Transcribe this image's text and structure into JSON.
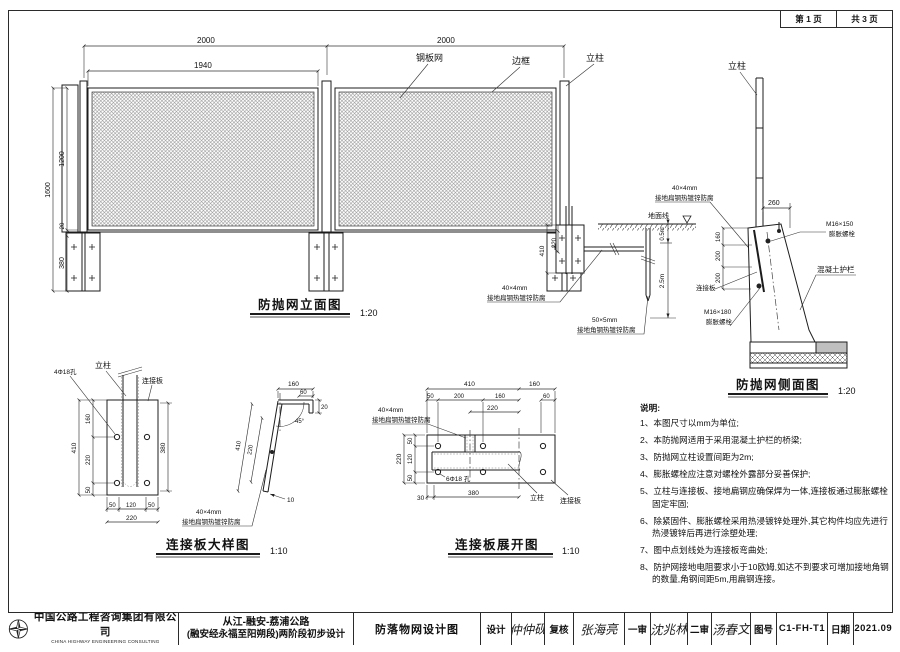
{
  "sheet": {
    "page_label": "第 1 页",
    "pages_label": "共 3 页"
  },
  "elevation": {
    "title": "防抛网立面图",
    "scale": "1:20",
    "dim_span1": "2000",
    "dim_span2": "2000",
    "dim_mesh_w": "1940",
    "dim_total_h": "1600",
    "dim_mesh_h": "1200",
    "dim_gap": "20",
    "dim_plate_h": "380",
    "label_mesh": "钢板网",
    "label_frame": "边框",
    "label_post": "立柱"
  },
  "anchor": {
    "label_ground": "地面线",
    "dim_410": "410",
    "dim_220": "220",
    "dim_depth1": "0.5m",
    "dim_depth2": "2.5m",
    "flat_spec": "40×4mm",
    "flat_name": "接地扁钢热镀锌防腐",
    "angle_spec": "50×5mm",
    "angle_name": "接地角钢热镀锌防腐"
  },
  "side": {
    "title": "防抛网侧面图",
    "scale": "1:20",
    "label_post": "立柱",
    "dim_260": "260",
    "bolt_top_spec": "M16×150",
    "bolt_top_name": "膨胀螺栓",
    "label_barrier": "混凝土护栏",
    "label_plate": "连接板",
    "bolt_bot_spec": "M16×180",
    "bolt_bot_name": "膨胀螺栓",
    "flat_spec": "40×4mm",
    "flat_name": "接地扁钢热镀锌防腐",
    "dim_160": "160",
    "dim_200a": "200",
    "dim_200b": "200"
  },
  "plate_detail": {
    "title": "连接板大样图",
    "scale": "1:10",
    "label_post": "立柱",
    "label_plate": "连接板",
    "label_holes": "4Φ18孔",
    "dim_total": "410",
    "dim_160": "160",
    "dim_220": "220",
    "dim_50": "50",
    "dim_b220": "220",
    "dim_b50a": "50",
    "dim_b120": "120",
    "dim_b50b": "50",
    "dim_380": "380",
    "p_160": "160",
    "p_60": "60",
    "p_20": "20",
    "p_220": "220",
    "p_410": "410",
    "p_10": "10",
    "p_angle": "45°",
    "flat_spec": "40×4mm",
    "flat_name": "接地扁钢热镀锌防腐"
  },
  "unfold": {
    "title": "连接板展开图",
    "scale": "1:10",
    "t_410": "410",
    "t_160": "160",
    "t_50": "50",
    "t_200": "200",
    "t_160b": "160",
    "t_60": "60",
    "t_220": "220",
    "l_220": "220",
    "l_50a": "50",
    "l_120": "120",
    "l_50b": "50",
    "b_30": "30",
    "b_380": "380",
    "label_holes": "6Φ18 孔",
    "label_post": "立柱",
    "label_plate": "连接板",
    "flat_spec": "40×4mm",
    "flat_name": "接地扁钢热镀锌防腐"
  },
  "notes": {
    "heading": "说明:",
    "items": [
      "1、本图尺寸以mm为单位;",
      "2、本防抛网适用于采用混凝土护栏的桥梁;",
      "3、防抛网立柱设置间距为2m;",
      "4、膨胀螺栓应注意对螺栓外露部分妥善保护;",
      "5、立柱与连接板、接地扁钢应确保焊为一体,连接板通过膨胀螺栓固定牢固;",
      "6、除紧固件、膨胀螺栓采用热浸镀锌处理外,其它构件均应先进行热浸镀锌后再进行涂塑处理;",
      "7、图中点划线处为连接板弯曲处;",
      "8、防护网接地电阻要求小于10欧姆,如达不到要求可增加接地角钢的数量,角钢间距5m,用扁钢连接。"
    ]
  },
  "titleblock": {
    "company": "中国公路工程咨询集团有限公司",
    "company_en": "CHINA HIGHWAY ENGINEERING CONSULTING CORPORATION",
    "project_line1": "从江-融安-荔浦公路",
    "project_line2": "(融安经永福至阳朔段)两阶段初步设计",
    "drawing_title": "防落物网设计图",
    "design_label": "设计",
    "design_sig": "仲仲砚",
    "check_label": "复核",
    "check_sig": "张海亮",
    "review1_label": "一审",
    "review1_sig": "沈兆林",
    "review2_label": "二审",
    "review2_sig": "汤春文",
    "drawing_no_label": "图号",
    "drawing_no": "C1-FH-T1",
    "date_label": "日期",
    "date": "2021.09"
  }
}
